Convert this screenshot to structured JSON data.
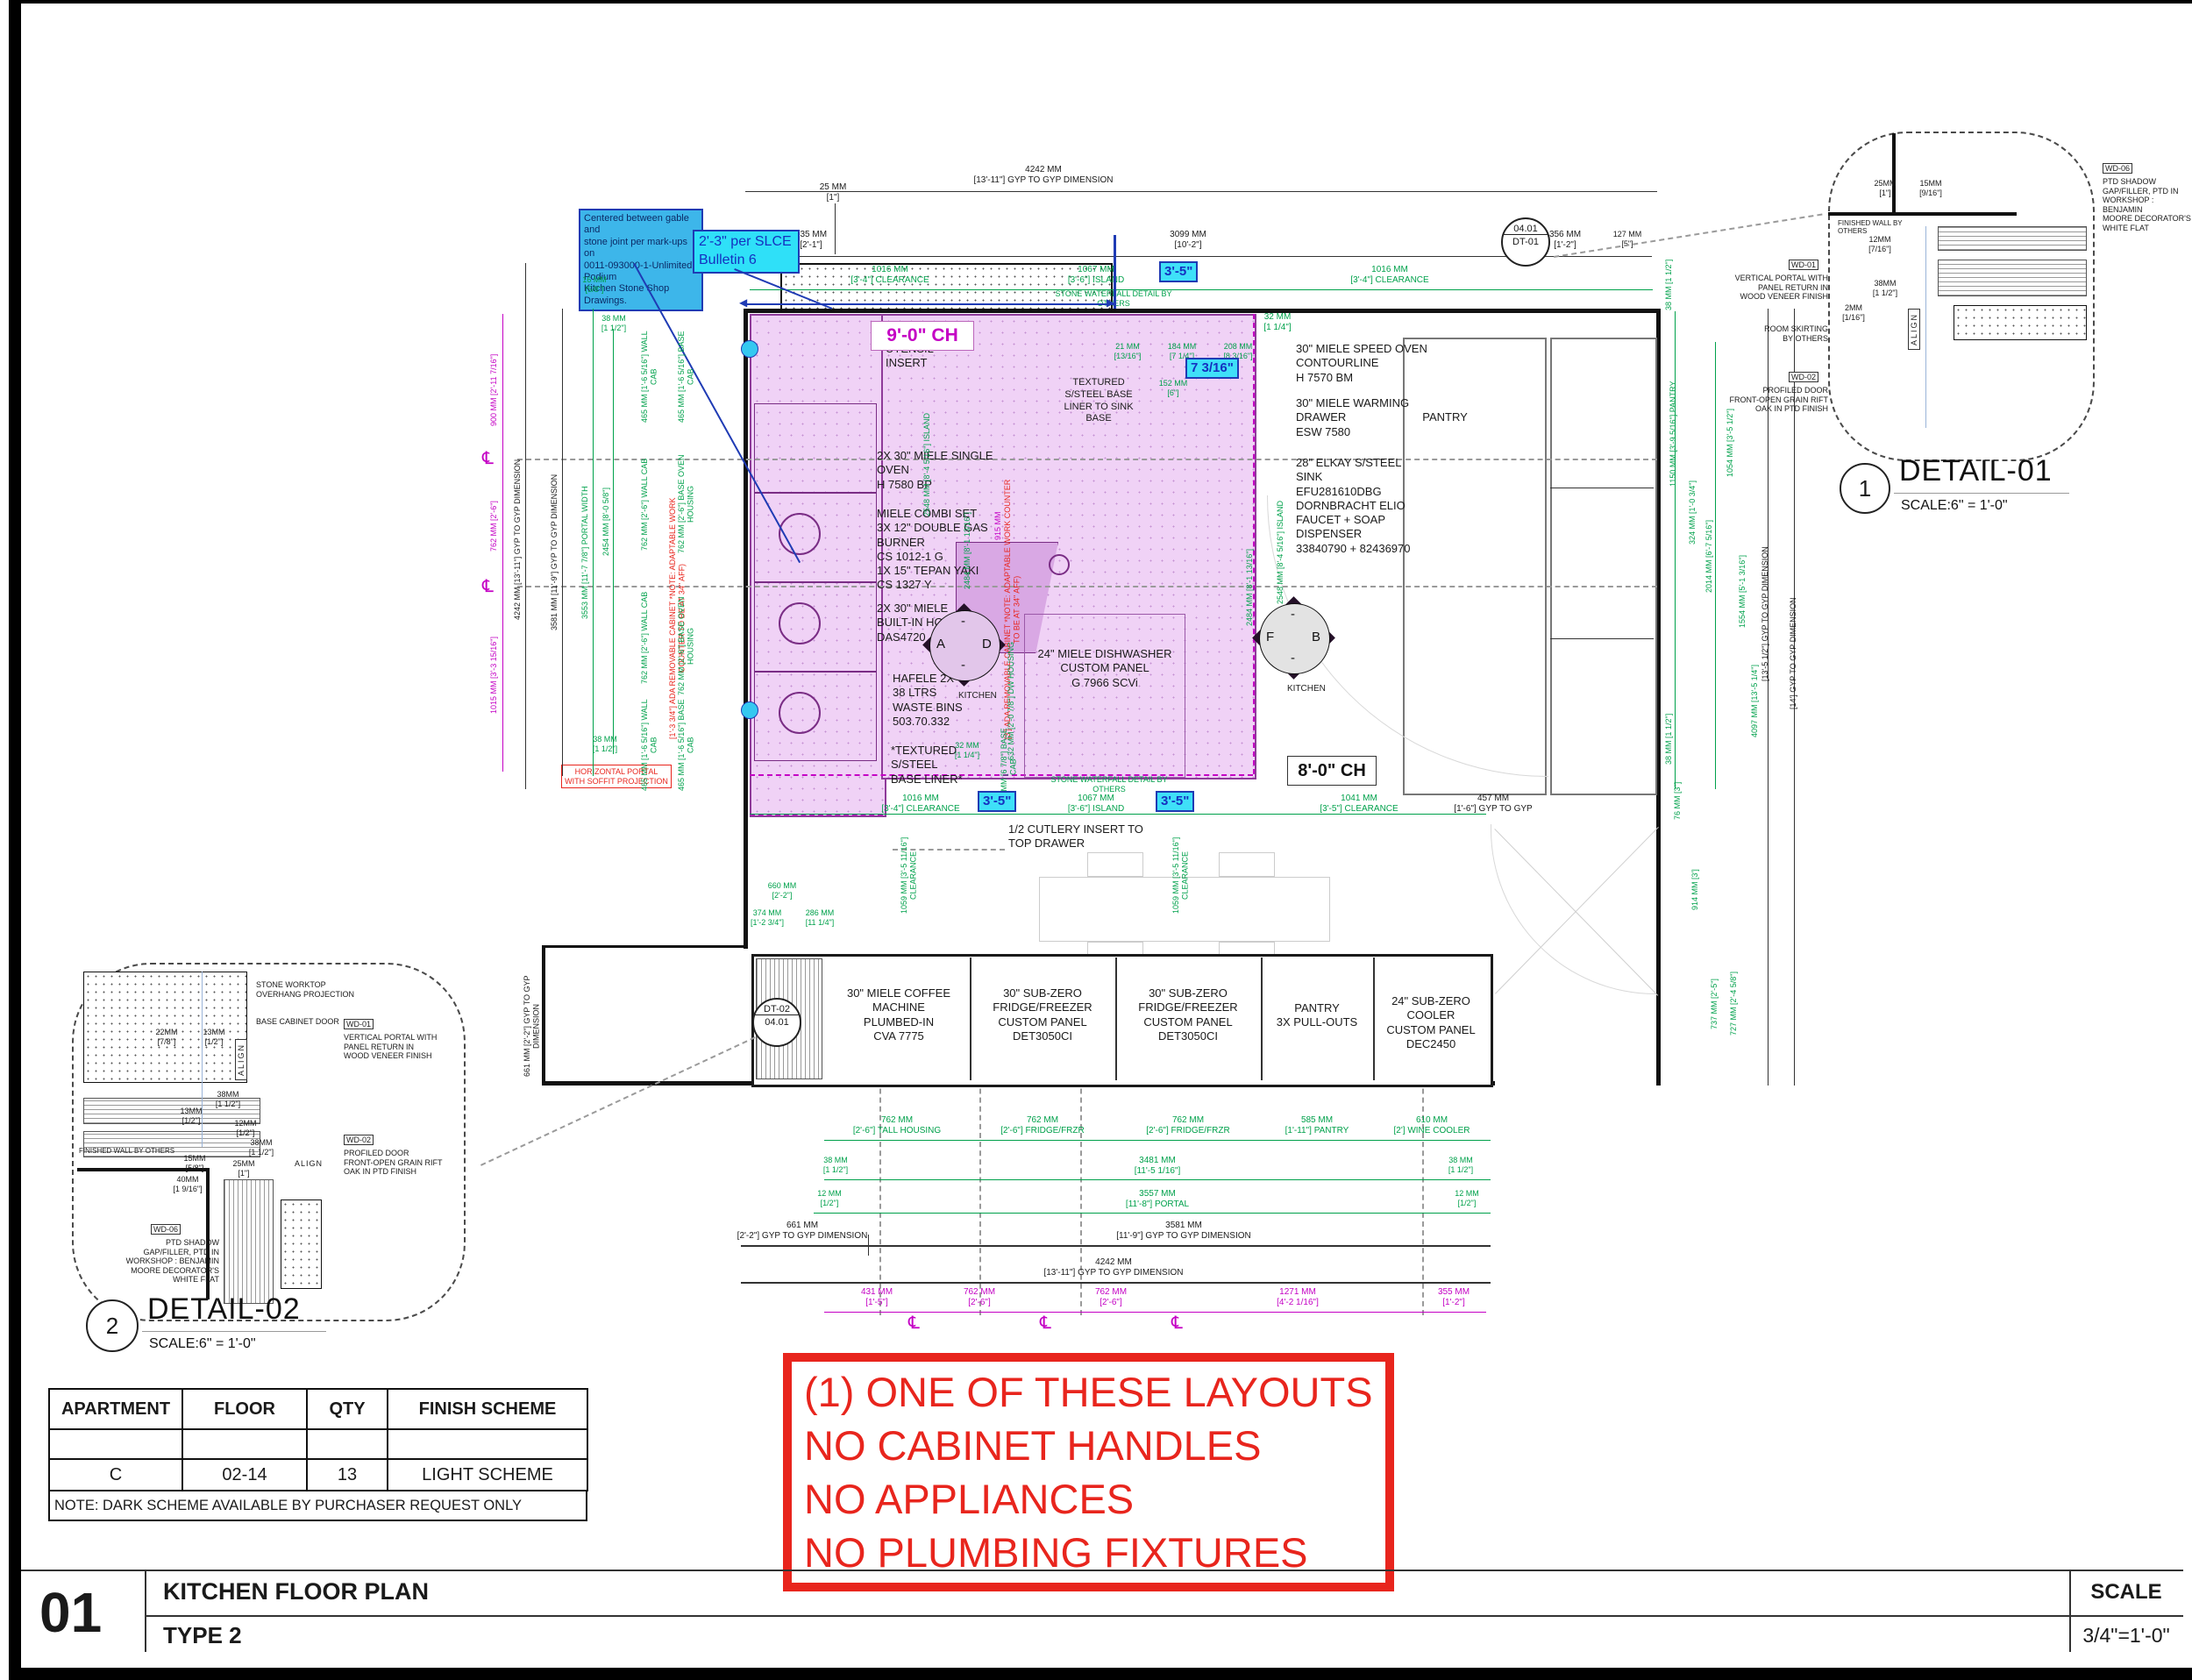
{
  "title_block": {
    "number": "01",
    "title": "KITCHEN FLOOR PLAN",
    "subtitle": "TYPE 2",
    "scale_label": "SCALE",
    "scale_value": "3/4\"=1'-0\""
  },
  "red_box": {
    "line1": "(1) ONE OF THESE LAYOUTS",
    "line2": "NO CABINET HANDLES",
    "line3": "NO APPLIANCES",
    "line4": "NO PLUMBING FIXTURES",
    "color": "#e8251d"
  },
  "schedule": {
    "headers": [
      "APARTMENT",
      "FLOOR",
      "QTY",
      "FINISH SCHEME"
    ],
    "row_empty": [
      "",
      "",
      "",
      ""
    ],
    "row": [
      "C",
      "02-14",
      "13",
      "LIGHT SCHEME"
    ],
    "note": "NOTE:  DARK SCHEME AVAILABLE BY PURCHASER REQUEST ONLY"
  },
  "notes": {
    "blue": "Centered between gable and\nstone joint per mark-ups on\n0011-093000-1-Unlimited Podium\nKitchen Stone Shop Drawings.",
    "cyan": "2'-3\" per SLCE\nBulletin 6"
  },
  "colors": {
    "dim_green": "#00a14b",
    "dim_magenta": "#c400c4",
    "note_red": "#e8251d",
    "cyan_fill": "#3fe0f8",
    "blue": "#1f3bb4",
    "plan_fill": "#f0d2f6",
    "plan_line": "#8e3a99"
  },
  "plan": {
    "top": {
      "d4242": "4242 MM\n[13'-11\"] GYP TO GYP DIMENSION",
      "d25": "25 MM\n[1\"]",
      "d635": "635 MM\n[2'-1\"]",
      "d3099": "3099 MM\n[10'-2\"]",
      "d356": "356 MM\n[1'-2\"]",
      "d127": "127 MM\n[5\"]",
      "c_left": "1016 MM\n[3'-4\"] CLEARANCE",
      "c_island": "1067 MM\n[3'-6\"] ISLAND",
      "c_right": "1016 MM\n[3'-4\"] CLEARANCE",
      "d32": "32 MM\n[1 1/4\"]",
      "tag35": "3'-5\""
    },
    "mid": {
      "c_left": "1016 MM\n[3'-4\"] CLEARANCE",
      "c_island": "1067 MM\n[3'-6\"] ISLAND",
      "c_right": "1041 MM\n[3'-5\"] CLEARANCE",
      "tag35": "3'-5\"",
      "d457": "457 MM\n[1'-6\"] GYP TO GYP",
      "clv": "1059 MM [3'-5 11/16\"] CLEARANCE",
      "d660": "660 MM\n[2'-2\"]",
      "d374": "374 MM\n[1'-2 3/4\"]",
      "d286": "286 MM\n[11 1/4\"]",
      "stone_note": "STONE WATERFALL DETAIL BY OTHERS"
    },
    "island_dims": {
      "d21": "21 MM\n[13/16\"]",
      "d184": "184 MM\n[7 1/4\"]",
      "d208": "208 MM\n[8 3/16\"]",
      "d152": "152 MM\n[6\"]",
      "tag7316": "7 3/16\""
    },
    "labels": {
      "utensil": "UTENSIL\nINSERT",
      "ch9": "9'-0\" CH",
      "ch8": "8'-0\" CH",
      "single_oven": "2X 30\" MIELE SINGLE\nOVEN\nH 7580 BP",
      "combi": "MIELE COMBI SET\n3X 12\" DOUBLE GAS\nBURNER\nCS 1012-1 G\n1X 15\" TEPAN YAKI\nCS 1327 Y",
      "hood": "2X 30\" MIELE\nBUILT-IN HOOD\nDAS4720",
      "hafele": "HAFELE 2X\n38 LTRS\nWASTE BINS\n503.70.332",
      "textured": "*TEXTURED\nS/STEEL\nBASE LINER*",
      "sink_liner": "TEXTURED\nS/STEEL BASE\nLINER TO SINK\nBASE",
      "dishwasher": "24\" MIELE DISHWASHER\nCUSTOM PANEL\nG 7966 SCVi",
      "speed_oven": "30\" MIELE SPEED OVEN\nCONTOURLINE\nH 7570 BM",
      "warming": "30\" MIELE WARMING\nDRAWER\nESW 7580",
      "sink": "28\" ELKAY S/STEEL\nSINK\nEFU281610DBG\nDORNBRACHT ELIO\nFAUCET + SOAP\nDISPENSER\n33840790 + 82436970",
      "pantry": "PANTRY",
      "kitchen": "KITCHEN",
      "cutlery": "1/2 CUTLERY INSERT TO\nTOP DRAWER",
      "ada_left": "[1'-3 3/4\"] ADA REMOVABLE CABINET  *NOTE: ADAPTABLE WORK COUNTER TO BE AT 34\" AFF)",
      "ada_right": "[3'] ADA REMOVABLE CABINET  *NOTE: ADAPTABLE WORK COUNTER TO BE AT 34\" AFF)",
      "horiz_portal": "HORIZONTAL PORTAL\nWITH SOFFIT PROJECTION",
      "marker_a": "A",
      "marker_d": "D",
      "marker_f": "F",
      "marker_b": "B"
    },
    "run": {
      "coffee": "30\" MIELE COFFEE\nMACHINE\nPLUMBED-IN\nCVA 7775",
      "fridge1": "30\" SUB-ZERO\nFRIDGE/FREEZER\nCUSTOM PANEL\nDET3050CI",
      "fridge2": "30\" SUB-ZERO\nFRIDGE/FREEZER\nCUSTOM PANEL\nDET3050CI",
      "pantry": "PANTRY\n3X PULL-OUTS",
      "cooler": "24\" SUB-ZERO\nCOOLER\nCUSTOM PANEL\nDEC2450"
    },
    "bubbles": {
      "dt01_top": "04.01",
      "dt01_bottom": "DT-01",
      "dt02_top": "DT-02",
      "dt02_bottom": "04.01"
    },
    "bottom": {
      "r1": [
        "762 MM\n[2'-6\"] TALL HOUSING",
        "762 MM\n[2'-6\"] FRIDGE/FRZR",
        "762 MM\n[2'-6\"] FRIDGE/FRZR",
        "585 MM\n[1'-11\"] PANTRY",
        "610 MM\n[2'] WINE COOLER"
      ],
      "d38l": "38 MM\n[1 1/2\"]",
      "d12l": "12 MM\n[1/2\"]",
      "d38r": "38 MM\n[1 1/2\"]",
      "d12r": "12 MM\n[1/2\"]",
      "d3481": "3481 MM\n[11'-5 1/16\"]",
      "d3557": "3557 MM\n[11'-8\"] PORTAL",
      "d661": "661 MM\n[2'-2\"] GYP TO GYP DIMENSION",
      "d3581": "3581 MM\n[11'-9\"] GYP TO GYP DIMENSION",
      "d4242": "4242 MM\n[13'-11\"] GYP TO GYP DIMENSION",
      "d661v": "661 MM [2'-2\"] GYP TO GYP DIMENSION",
      "m": [
        "431 MM\n[1'-5\"]",
        "762 MM\n[2'-6\"]",
        "762 MM\n[2'-6\"]",
        "1271 MM\n[4'-2 1/16\"]",
        "355 MM\n[1'-2\"]"
      ],
      "cl": "℄"
    },
    "left_dims": {
      "black": [
        "4242 MM [13'-11\"] GYP TO GYP DIMENSION",
        "3581 MM [11'-9\"] GYP TO GYP DIMENSION"
      ],
      "green": [
        "3553 MM [11'-7 7/8\"] PORTAL WIDTH",
        "2454 MM [8'-0 5/8\"]",
        "465 MM [1'-6 5/16\"] WALL CAB",
        "465 MM [1'-6 5/16\"] BASE CAB",
        "762 MM [2'-6\"] WALL CAB",
        "762 MM [2'-6\"] BASE OVEN HOUSING",
        "762 MM [2'-6\"] WALL CAB",
        "762 MM [2'-6\"] BASE OVEN HOUSING",
        "465 MM [1'-6 5/16\"] WALL CAB",
        "465 MM [1'-6 5/16\"] BASE CAB"
      ],
      "small_top": [
        "16 MM\n[5/8\"]",
        "38 MM\n[1 1/2\"]"
      ],
      "small_bottom": "38 MM\n[1 1/2\"]",
      "magenta": [
        "900 MM [2'-11 7/16\"]",
        "762 MM [2'-6\"]",
        "1015 MM [3'-3 15/16\"]"
      ]
    },
    "right_dims": {
      "green": [
        "38 MM [1 1/2\"]",
        "1150 MM [3'-9 5/16\"] PANTRY",
        "324 MM [1'-0 3/4\"]",
        "2014 MM [6'-7 5/16\"]",
        "1054 MM [3'-5 1/2\"]",
        "1554 MM [5'-1 3/16\"]",
        "4097 MM [13'-5 1/4\"]",
        "38 MM [1 1/2\"]",
        "76 MM [3\"]",
        "914 MM [3']",
        "737 MM [2'-5\"]",
        "727 MM [2'-4 5/8\"]"
      ],
      "black": [
        "[13'-5 1/2\"] GYP TO GYP DIMENSION",
        "[14'] GYP TO GYP DIMENSION"
      ]
    },
    "inner_dims": {
      "island_l1": "2548 MM [8'-4 5/16\"] ISLAND",
      "island_l2": "2484 MM [8'-1 13/16\"]",
      "island_m": "915 MM",
      "island_r1": "2548 MM [8'-4 5/16\"] ISLAND",
      "island_r2": "2484 MM [8'-1 13/16\"]",
      "dw": "632 MM [2'-0 7/8\"] DW HOUSING",
      "base_cab": "175 MM [6 7/8\"] BASE CAB",
      "d32": "32 MM\n[1 1/4\"]"
    }
  },
  "detail01": {
    "num": "1",
    "name": "DETAIL-01",
    "scale": "SCALE:6\" = 1'-0\"",
    "wd06": "WD-06",
    "wd06_text": "PTD SHADOW\nGAP/FILLER, PTD IN\nWORKSHOP : BENJAMIN\nMOORE DECORATOR'S\nWHITE FLAT",
    "wd01": "WD-01",
    "wd01_text": "VERTICAL PORTAL WITH\nPANEL RETURN IN\nWOOD VENEER FINISH",
    "skirting": "ROOM SKIRTING\nBY OTHERS",
    "wd02": "WD-02",
    "wd02_text": "PROFILED DOOR\nFRONT-OPEN GRAIN RIFT\nOAK IN PTD FINISH",
    "finished_wall": "FINISHED WALL BY OTHERS",
    "align": "ALIGN",
    "dims": [
      "25MM\n[1\"]",
      "15MM\n[9/16\"]",
      "12MM\n[7/16\"]",
      "38MM\n[1 1/2\"]",
      "2MM\n[1/16\"]"
    ]
  },
  "detail02": {
    "num": "2",
    "name": "DETAIL-02",
    "scale": "SCALE:6\" = 1'-0\"",
    "stone": "STONE WORKTOP\nOVERHANG PROJECTION",
    "base_door": "BASE CABINET DOOR",
    "wd01": "WD-01",
    "wd01_text": "VERTICAL PORTAL WITH\nPANEL RETURN IN\nWOOD VENEER FINISH",
    "wd02": "WD-02",
    "wd02_text": "PROFILED DOOR\nFRONT-OPEN GRAIN RIFT\nOAK IN PTD FINISH",
    "wd06": "WD-06",
    "wd06_text": "PTD SHADOW\nGAP/FILLER, PTD IN\nWORKSHOP : BENJAMIN\nMOORE DECORATOR'S\nWHITE FLAT",
    "finished_wall": "FINISHED WALL BY OTHERS",
    "align": "ALIGN",
    "dims": [
      "22MM\n[7/8\"]",
      "13MM\n[1/2\"]",
      "38MM\n[1 1/2\"]",
      "13MM\n[1/2\"]",
      "12MM\n[1/2\"]",
      "38MM\n[1 1/2\"]",
      "15MM\n[5/8\"]",
      "25MM\n[1\"]",
      "40MM\n[1 9/16\"]"
    ]
  }
}
